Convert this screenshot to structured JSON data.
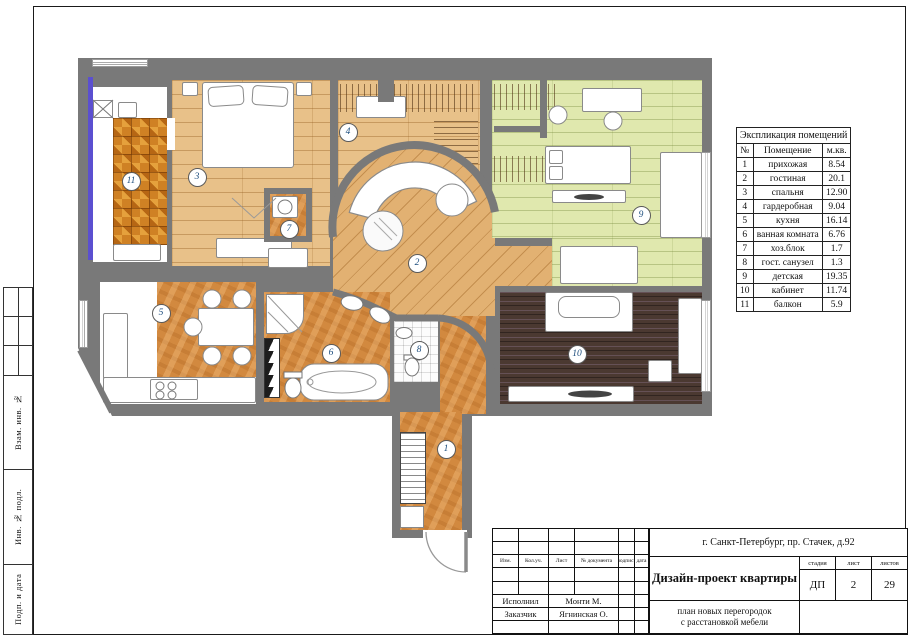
{
  "colors": {
    "wall": "#797979",
    "window_glass": "#5b4fd0",
    "accent_badge_num": "#1c4d7d",
    "floor_wood": "#e8c189",
    "floor_wood_diag": "#e2b172",
    "floor_green": "#e0e8ae",
    "floor_dark": "#4b3931",
    "floor_orange": "#d2893f",
    "floor_mosaic": "#cf8124"
  },
  "sidebar": {
    "labels": [
      {
        "label": "Взам. инв. №"
      },
      {
        "label": "Инв. № подл."
      },
      {
        "label": "Подп. и дата"
      }
    ]
  },
  "legend": {
    "title": "Экспликация помещений",
    "columns": {
      "num": "№",
      "name": "Помещение",
      "area": "м.кв."
    },
    "rows": [
      {
        "num": "1",
        "name": "прихожая",
        "area": "8.54"
      },
      {
        "num": "2",
        "name": "гостиная",
        "area": "20.1"
      },
      {
        "num": "3",
        "name": "спальня",
        "area": "12.90"
      },
      {
        "num": "4",
        "name": "гардеробная",
        "area": "9.04"
      },
      {
        "num": "5",
        "name": "кухня",
        "area": "16.14"
      },
      {
        "num": "6",
        "name": "ванная комната",
        "area": "6.76"
      },
      {
        "num": "7",
        "name": "хоз.блок",
        "area": "1.7"
      },
      {
        "num": "8",
        "name": "гост. санузел",
        "area": "1.3"
      },
      {
        "num": "9",
        "name": "детская",
        "area": "19.35"
      },
      {
        "num": "10",
        "name": "кабинет",
        "area": "11.74"
      },
      {
        "num": "11",
        "name": "балкон",
        "area": "5.9"
      }
    ]
  },
  "title_block": {
    "address": "г. Санкт-Петербург, пр. Стачек, д.92",
    "header_cols": [
      "Изм.",
      "Кол.уч.",
      "Лист",
      "№ документа",
      "подпись",
      "дата"
    ],
    "project_title": "Дизайн-проект квартиры",
    "subtitle_line1": "план новых перегородок",
    "subtitle_line2": "с расстановкой мебели",
    "stage_label": "стадия",
    "sheet_label": "лист",
    "sheets_label": "листов",
    "stage_value": "ДП",
    "sheet_value": "2",
    "sheets_value": "29",
    "executor_label": "Исполнил",
    "executor_value": "Монти М.",
    "client_label": "Заказчик",
    "client_value": "Ягнинская О."
  }
}
